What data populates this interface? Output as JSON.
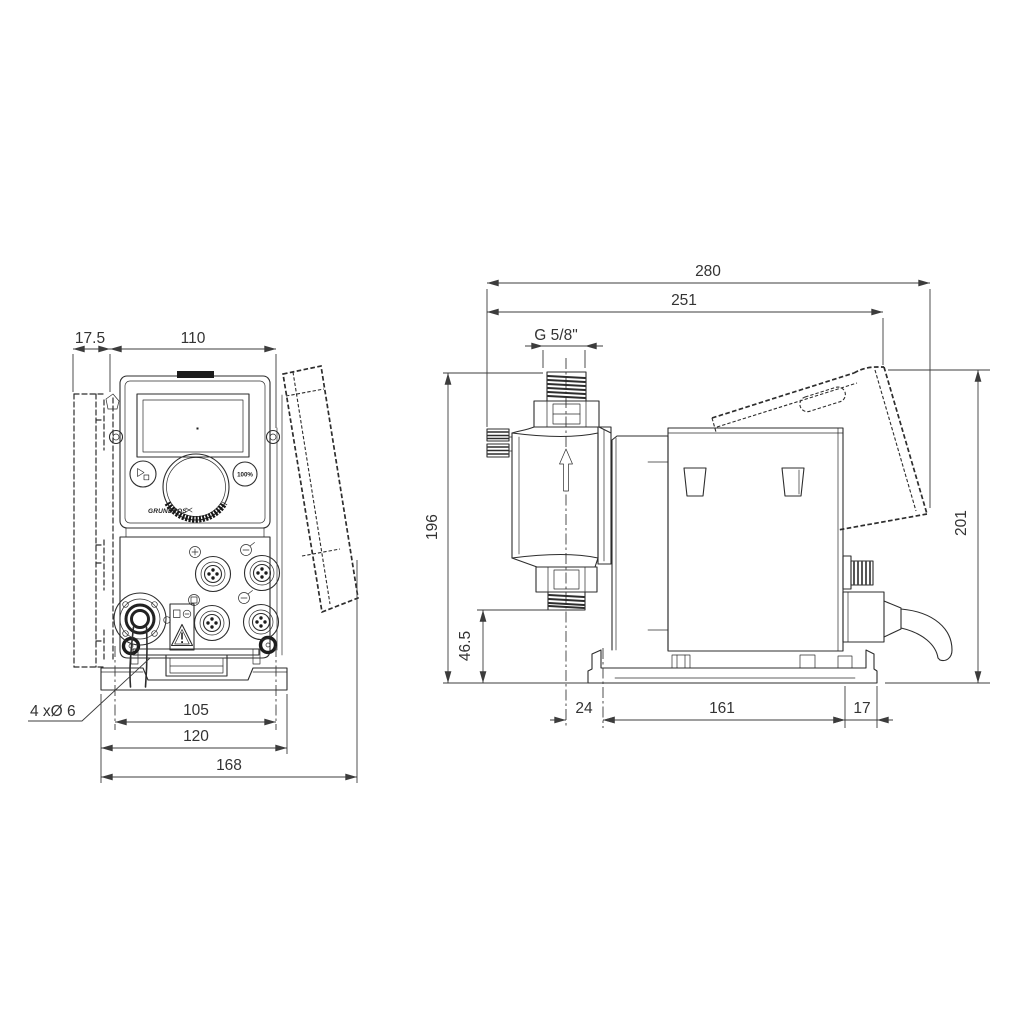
{
  "front_view": {
    "dim_offset": "17.5",
    "dim_width": "110",
    "dim_hole_spacing": "105",
    "dim_plate_width": "120",
    "dim_total_width": "168",
    "holes_label": "4 xØ 6",
    "brand": "GRUNDFOS",
    "btn_100": "100%"
  },
  "side_view": {
    "dim_total_length": "280",
    "dim_cube_length": "251",
    "thread_label": "G 5/8\"",
    "dim_height_conn": "196",
    "dim_height_outlet": "46.5",
    "dim_total_height": "201",
    "dim_offset": "24",
    "dim_base_length": "161",
    "dim_base_end": "17"
  }
}
